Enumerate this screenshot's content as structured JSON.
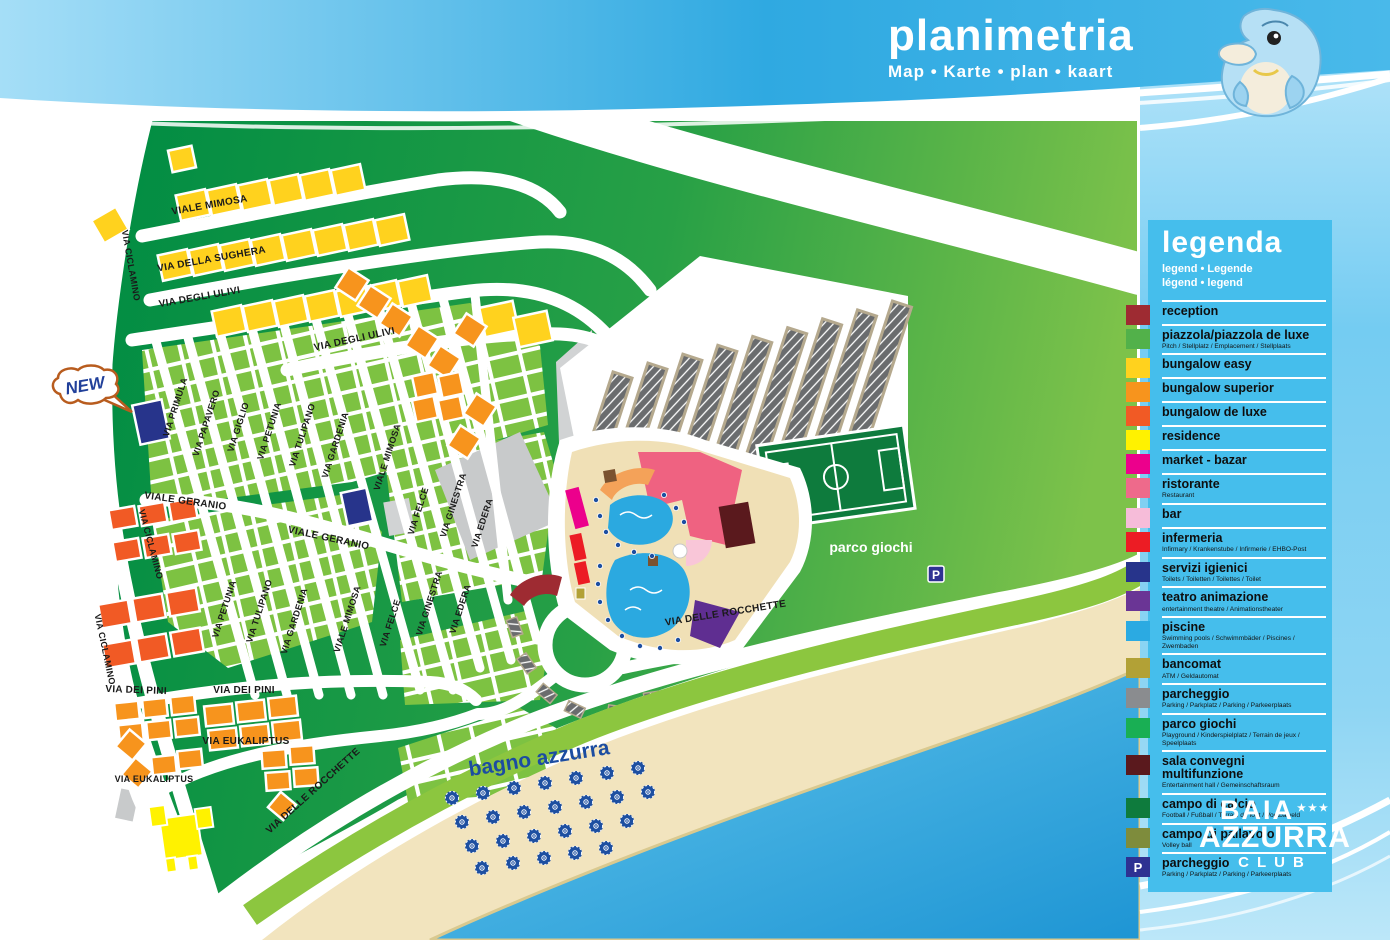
{
  "header": {
    "title": "planimetria",
    "subtitle": "Map • Karte • plan • kaart"
  },
  "legend": {
    "title": "legenda",
    "subtitle_line1": "legend • Legende",
    "subtitle_line2": "légend • legend",
    "items": [
      {
        "label": "reception",
        "sublabel": "",
        "color": "#9E2B32"
      },
      {
        "label": "piazzola/piazzola de luxe",
        "sublabel": "Pitch / Stellplatz / Emplacement / Stellplaats",
        "color": "#52B14A"
      },
      {
        "label": "bungalow easy",
        "sublabel": "",
        "color": "#FFD21E"
      },
      {
        "label": "bungalow superior",
        "sublabel": "",
        "color": "#F7941D"
      },
      {
        "label": "bungalow de luxe",
        "sublabel": "",
        "color": "#F15A25"
      },
      {
        "label": "residence",
        "sublabel": "",
        "color": "#FFF200"
      },
      {
        "label": "market - bazar",
        "sublabel": "",
        "color": "#EC008C"
      },
      {
        "label": "ristorante",
        "sublabel": "Restaurant",
        "color": "#EE6A8B"
      },
      {
        "label": "bar",
        "sublabel": "",
        "color": "#F6BCD9"
      },
      {
        "label": "infermeria",
        "sublabel": "Infirmary / Krankenstube / Infirmerie / EHBO-Post",
        "color": "#EC1C24"
      },
      {
        "label": "servizi igienici",
        "sublabel": "Toilets / Toiletten / Toilettes / Toilet",
        "color": "#27348B"
      },
      {
        "label": "teatro animazione",
        "sublabel": "entertainment theatre / Animationstheater",
        "color": "#6A3595"
      },
      {
        "label": "piscine",
        "sublabel": "Swimming pools / Schwimmbäder / Piscines / Zwembaden",
        "color": "#2BAAE2"
      },
      {
        "label": "bancomat",
        "sublabel": "ATM / Geldautomat",
        "color": "#B2A136"
      },
      {
        "label": "parcheggio",
        "sublabel": "Parking / Parkplatz / Parking / Parkeerplaats",
        "color": "#8A8C8F"
      },
      {
        "label": "parco giochi",
        "sublabel": "Playground / Kinderspielplatz / Terrain de jeux / Speelplaats",
        "color": "#19AF54"
      },
      {
        "label": "sala convegni multifunzione",
        "sublabel": "Entertainment hall / Gemeinschaftsraum",
        "color": "#5A191D"
      },
      {
        "label": "campo di calcio",
        "sublabel": "Football / Fußball / Terrain de foot / Voetbalveld",
        "color": "#0E7B3D"
      },
      {
        "label": "campo di pallavolo",
        "sublabel": "Volley ball",
        "color": "#7E8C3C"
      },
      {
        "label": "parcheggio",
        "sublabel": "Parking / Parkplatz / Parking / Parkeerplaats",
        "color": "#2E3192",
        "icon": "P"
      }
    ]
  },
  "logo": {
    "line1": "BAIA",
    "stars": "★★★",
    "line2": "AZZURRA",
    "line3": "CLUB"
  },
  "map": {
    "streets": [
      {
        "label": "VIALE MIMOSA"
      },
      {
        "label": "VIA DELLA SUGHERA"
      },
      {
        "label": "VIA CICLAMINO"
      },
      {
        "label": "VIA DEGLI ULIVI"
      },
      {
        "label": "VIA DEGLI ULIVI"
      },
      {
        "label": "VIA PRIMULA"
      },
      {
        "label": "VIA PAPAVERO"
      },
      {
        "label": "VIA GIGLIO"
      },
      {
        "label": "VIA PETUNIA"
      },
      {
        "label": "VIA TULIPANO"
      },
      {
        "label": "VIA GARDENIA"
      },
      {
        "label": "VIALE MIMOSA"
      },
      {
        "label": "VIA FELCE"
      },
      {
        "label": "VIA GINESTRA"
      },
      {
        "label": "VIA EDERA"
      },
      {
        "label": "VIALE GERANIO"
      },
      {
        "label": "VIALE GERANIO"
      },
      {
        "label": "VIA CICLAMINO"
      },
      {
        "label": "VIA PETUNIA"
      },
      {
        "label": "VIA TULIPANO"
      },
      {
        "label": "VIA GARDENIA"
      },
      {
        "label": "VIALE MIMOSA"
      },
      {
        "label": "VIA FELCE"
      },
      {
        "label": "VIA GINESTRA"
      },
      {
        "label": "VIA EDERA"
      },
      {
        "label": "VIA CICLAMINO"
      },
      {
        "label": "VIA DEI PINI"
      },
      {
        "label": "VIA DEI PINI"
      },
      {
        "label": "VIA EUKALIPTUS"
      },
      {
        "label": "VIA EUKALIPTUS"
      },
      {
        "label": "VIA DELLE ROCCHETTE"
      },
      {
        "label": "VIA DELLE ROCCHETTE"
      }
    ],
    "areas": {
      "parco_giochi": "parco giochi",
      "bagno_azzurra": "bagno azzurra"
    },
    "badges": {
      "new": "NEW"
    },
    "parking_icon": "P"
  },
  "colors": {
    "header_blue": "#2FA9E1",
    "sidebar_blue": "#8ED5F3",
    "land_green_dark": "#008C43",
    "land_green_light": "#7DC24A",
    "lot_green": "#7DC242",
    "sand": "#F2E4BE",
    "sea_blue": "#1E95D4",
    "road_white": "#FFFFFF"
  }
}
